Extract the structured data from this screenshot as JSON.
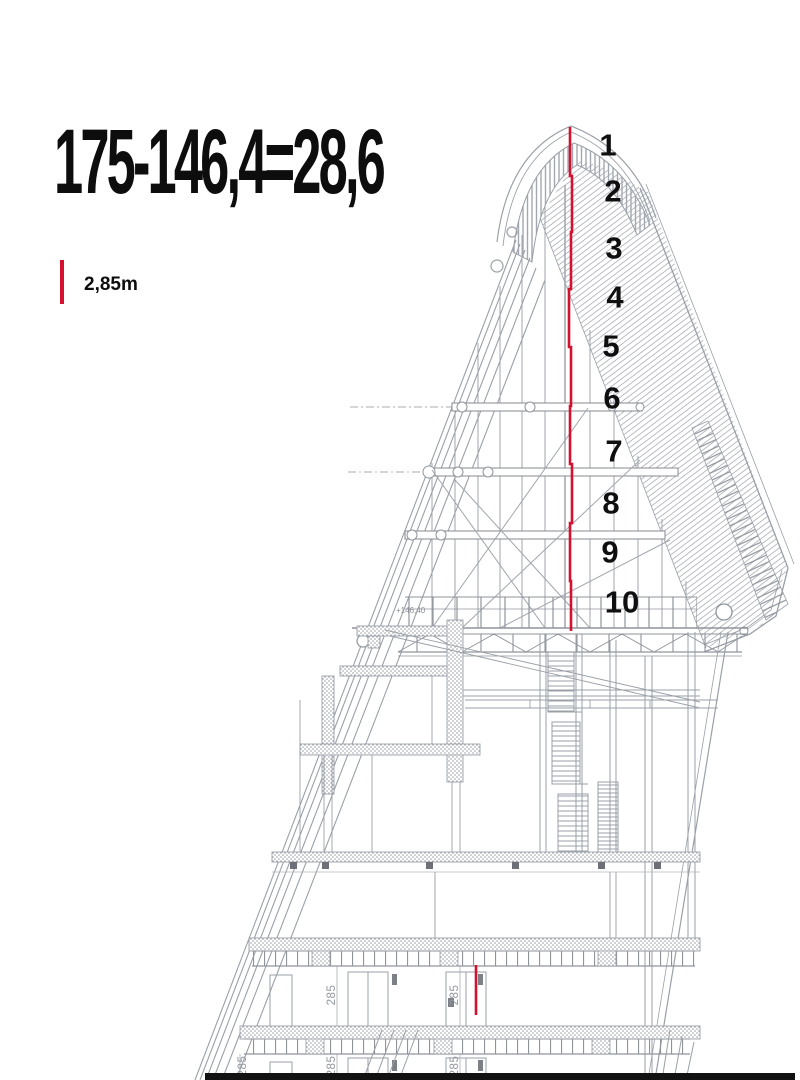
{
  "annotation": {
    "formula": "175-146,4=28,6",
    "scale_label": "2,85m",
    "level_label": "+146,40"
  },
  "section": {
    "floor_labels": [
      "1",
      "2",
      "3",
      "4",
      "5",
      "6",
      "7",
      "8",
      "9",
      "10"
    ],
    "dim_value": "285",
    "dim_label_count": 5
  },
  "colors": {
    "accent_red": "#d41230",
    "line_gray": "#9aa0a8",
    "text_black": "#111111",
    "background": "#ffffff"
  }
}
